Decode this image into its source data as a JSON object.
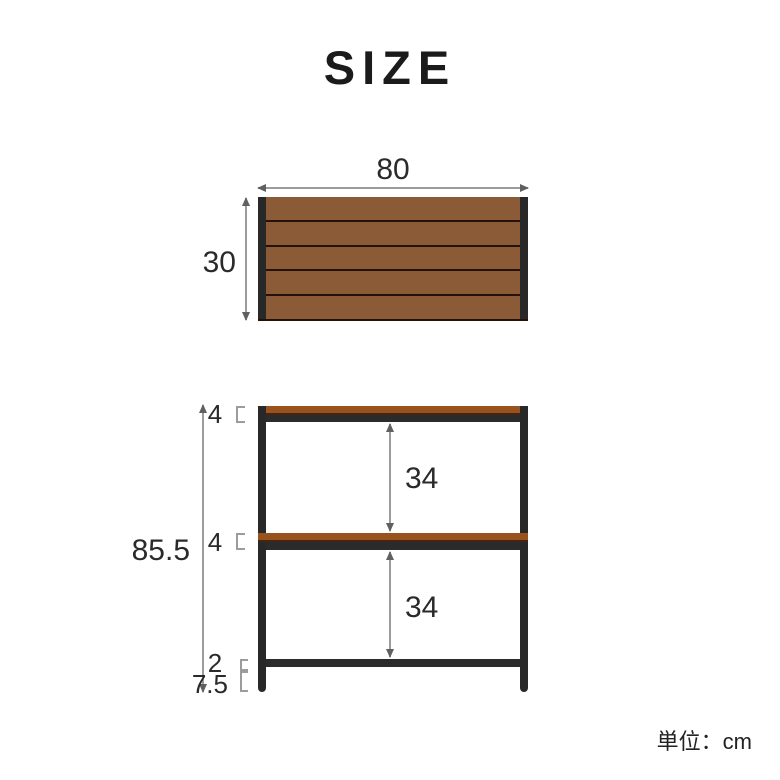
{
  "title": "SIZE",
  "unit_label": "単位：cm",
  "top_view": {
    "width": "80",
    "depth": "30",
    "plank_count": 5
  },
  "front_view": {
    "total_height": "85.5",
    "top_shelf_thickness": "4",
    "middle_shelf_thickness": "4",
    "upper_gap": "34",
    "lower_gap": "34",
    "bottom_bar_thickness": "2",
    "bottom_clearance": "7.5"
  },
  "colors": {
    "wood_top_view": "#8b5b37",
    "wood_front_view": "#98521e",
    "plank_seam": "#241208",
    "frame_black": "#282828",
    "arrow_line_gray": "#9c9c9c",
    "arrow_head_gray": "#606060",
    "text": "#2a2a2a",
    "background": "#ffffff"
  }
}
